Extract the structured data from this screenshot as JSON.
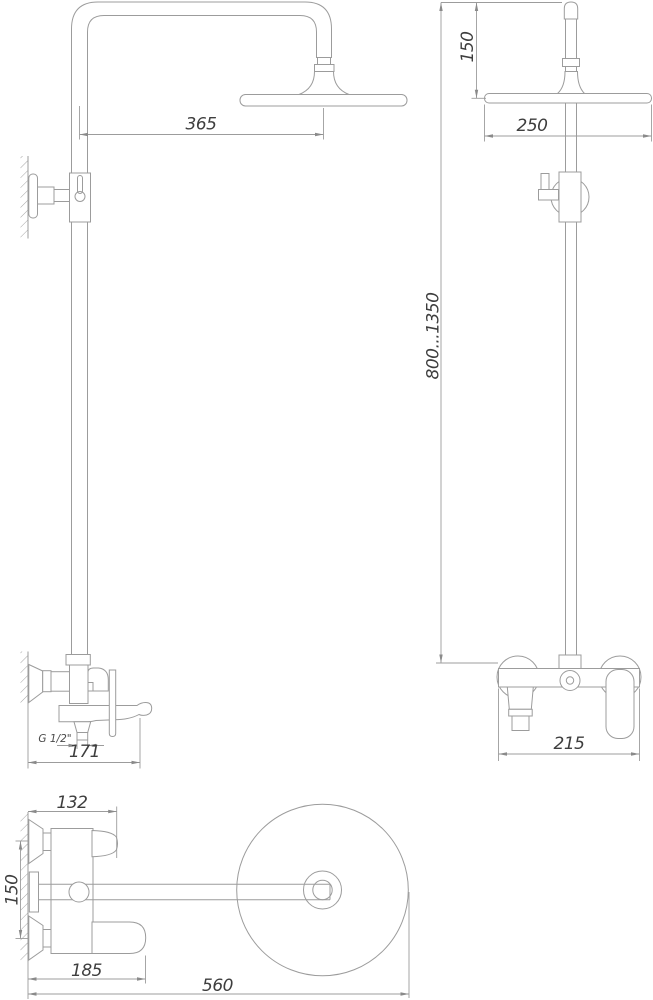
{
  "drawing": {
    "type": "shower-system-technical-drawing",
    "colors": {
      "line": "#9c9c9c",
      "text": "#3e3e3e",
      "background": "#ffffff"
    },
    "views": {
      "side_elevation": {
        "dim_arm_reach": "365",
        "dim_thread": "G 1/2\"",
        "dim_spout_reach": "171"
      },
      "front_elevation": {
        "dim_head_top_offset": "150",
        "dim_head_diameter": "250",
        "dim_column_height_range": "800...1350",
        "dim_mixer_width": "215"
      },
      "plan": {
        "dim_body_depth": "132",
        "dim_inlet_spacing": "150",
        "dim_spout_depth": "185",
        "dim_overall_depth": "560"
      }
    }
  }
}
